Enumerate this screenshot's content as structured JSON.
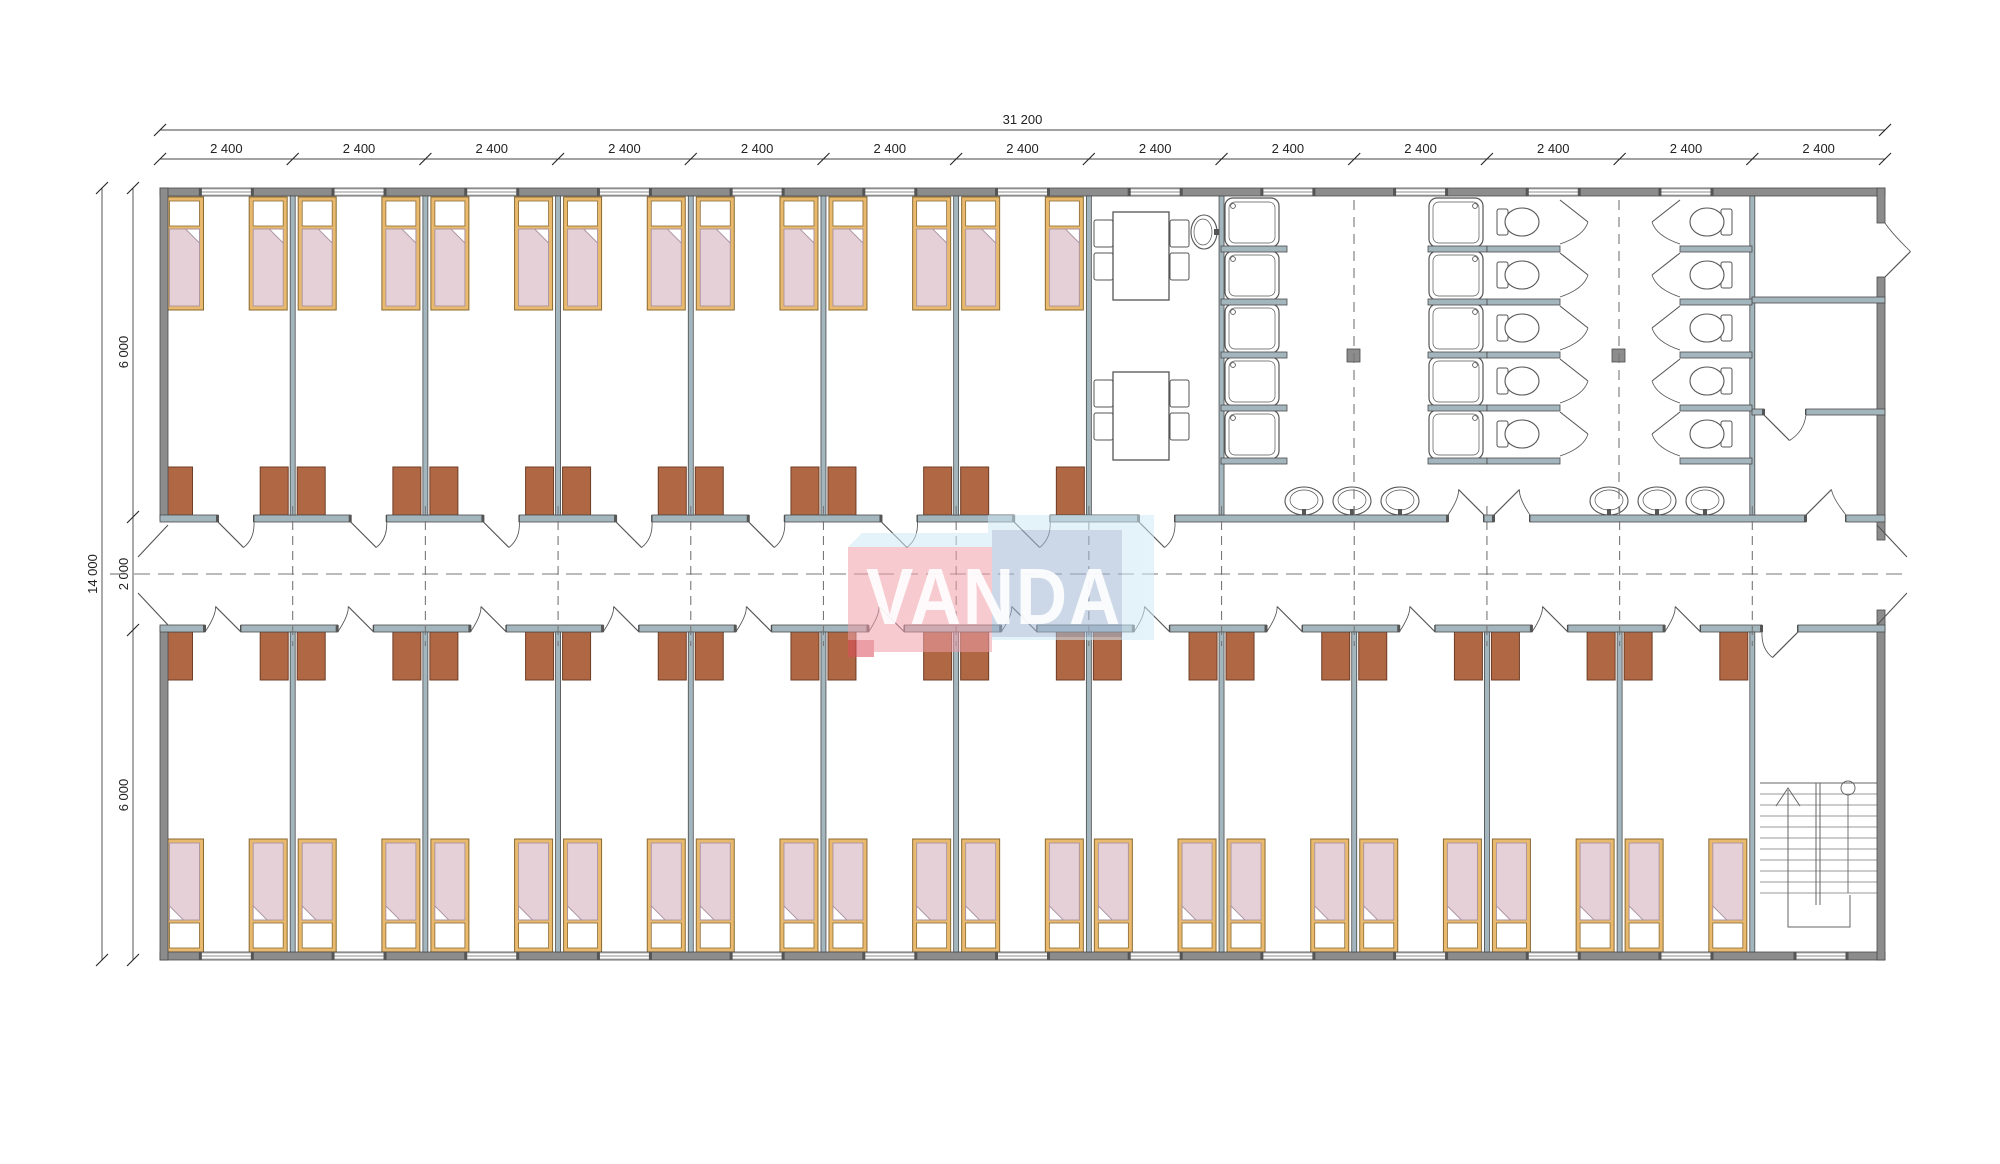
{
  "drawing": {
    "type": "modular-building-floor-plan",
    "dimensions": {
      "overall_width_label": "31 200",
      "module_label": "2 400",
      "module_labels": [
        "2 400",
        "2 400",
        "2 400",
        "2 400",
        "2 400",
        "2 400",
        "2 400",
        "2 400",
        "2 400",
        "2 400",
        "2 400",
        "2 400",
        "2 400"
      ],
      "module_count": 13,
      "overall_height_label": "14 000",
      "row_labels": [
        "6 000",
        "2 000",
        "6 000"
      ]
    },
    "watermark": {
      "text": "VANDA"
    },
    "layout_counts": {
      "top_bedrooms": 7,
      "bottom_bedrooms": 12,
      "beds_per_room": 2,
      "wardrobes_per_room": 2,
      "shower_columns": 2,
      "showers_per_column": 5,
      "toilet_columns": 2,
      "toilets_per_column": 5,
      "corridor_basins": 6,
      "commonroom_basins": 1,
      "tables": 2,
      "chairs_per_table": 4
    },
    "colors": {
      "wall_exterior": "#8c8c8c",
      "wall_interior": "#a4b6bd",
      "wall_stroke": "#4a4a4a",
      "bed_frame": "#e9ba6e",
      "bed_frame_stroke": "#8a6a33",
      "pillow": "#ffffff",
      "blanket": "#e4d0d6",
      "blanket_stroke": "#a992a0",
      "wardrobe": "#b06743",
      "wardrobe_stroke": "#6e3d26",
      "fixture_stroke": "#555555",
      "dash": "#777777",
      "dim": "#222222",
      "wm_pink": "#ef9fa9",
      "wm_blue": "#a3b9d6",
      "wm_lightblue": "#cfe9f7",
      "wm_red": "#dd4f5e",
      "wm_text": "#ffffff"
    }
  }
}
